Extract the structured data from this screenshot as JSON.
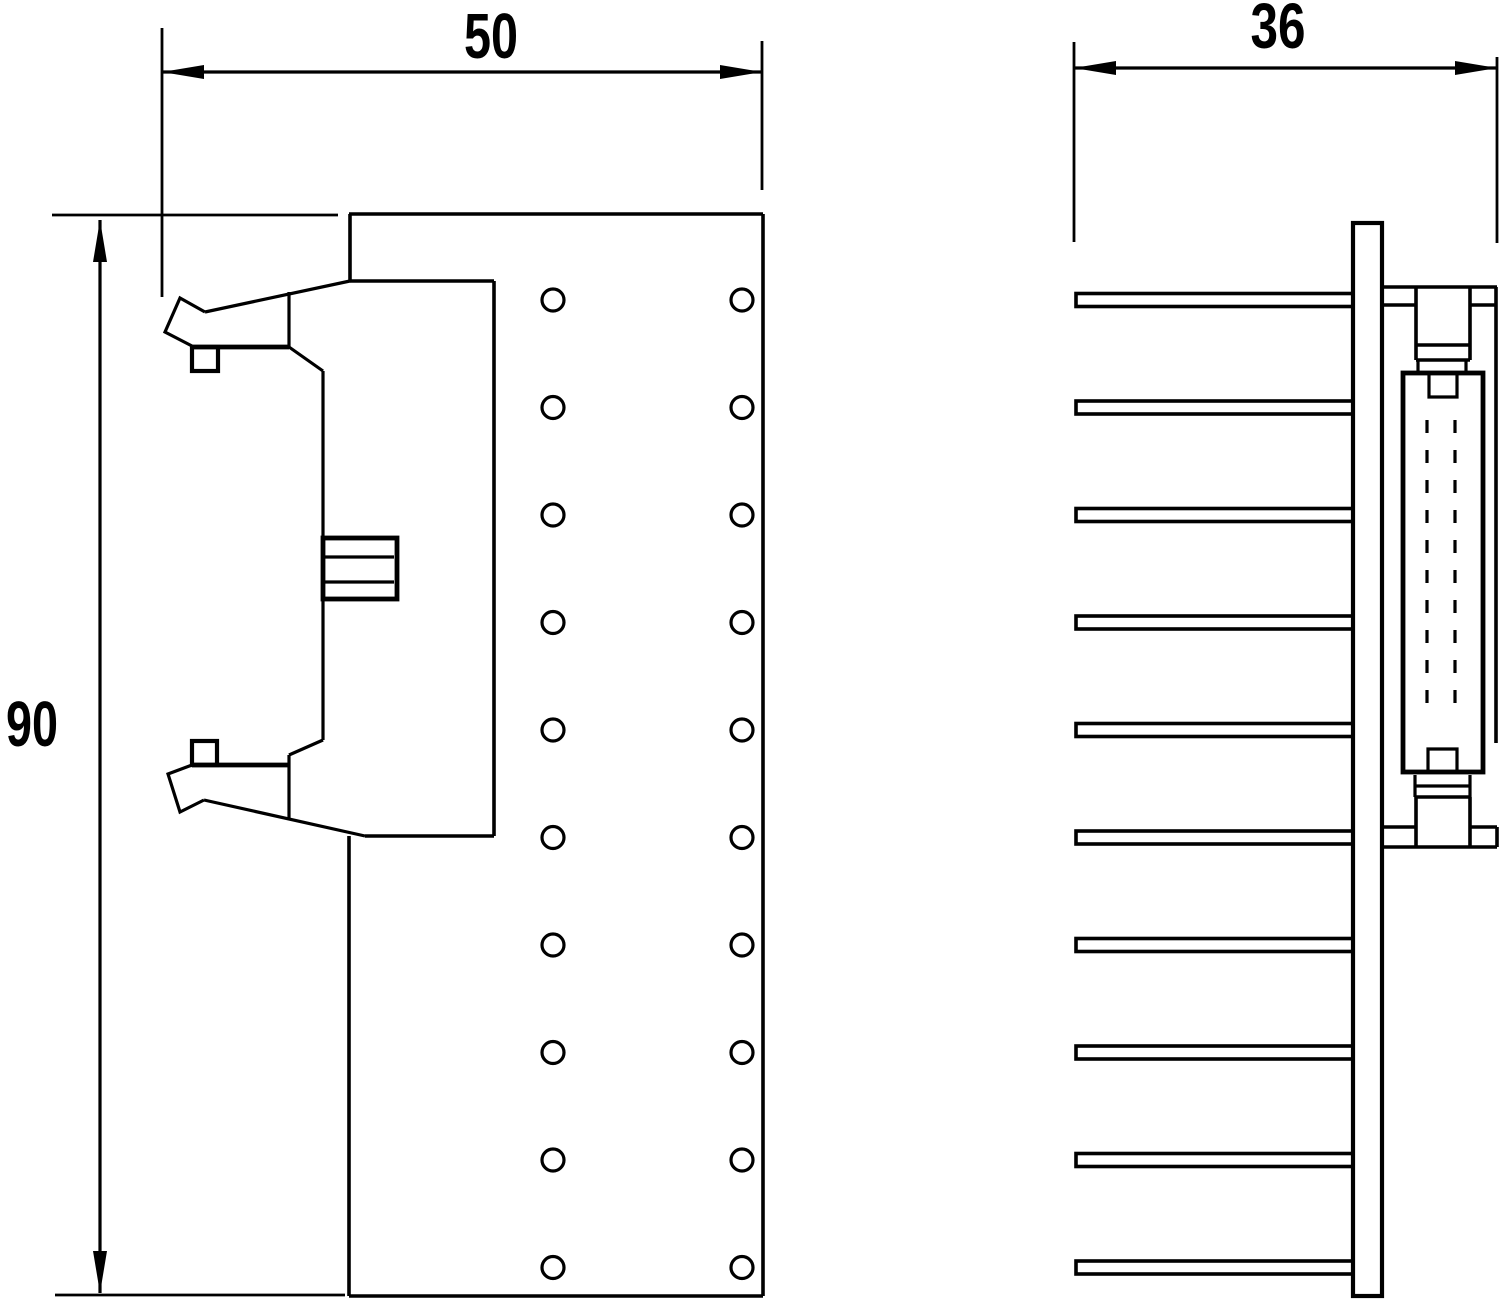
{
  "drawing": {
    "front_view": {
      "width_dim_label": "50",
      "height_dim_label": "90",
      "hole_rows": 10,
      "hole_columns": 2
    },
    "side_view": {
      "width_dim_label": "36",
      "pin_count": 10
    },
    "colors": {
      "line": "#000000",
      "background": "#ffffff"
    }
  }
}
